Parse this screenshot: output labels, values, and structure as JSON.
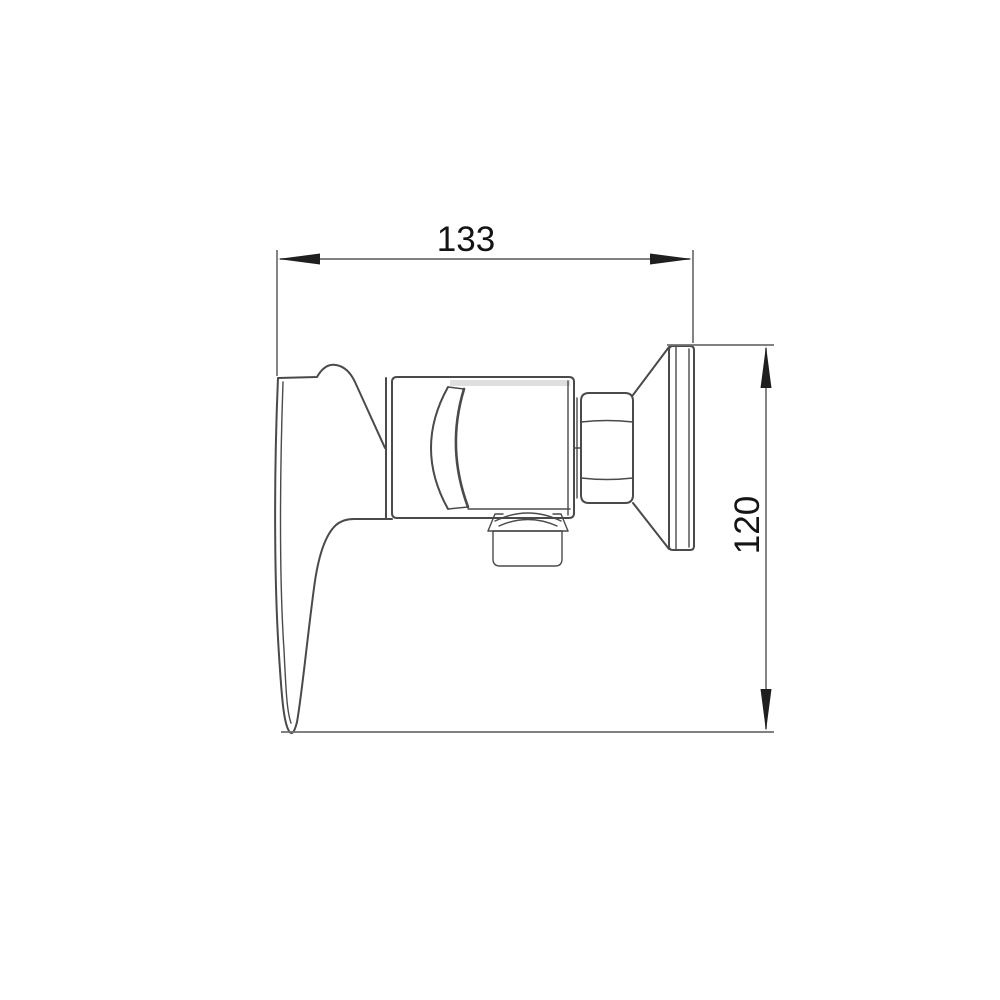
{
  "dimensions": {
    "width": "133",
    "height": "120"
  },
  "colors": {
    "background": "#ffffff",
    "outline": "#4a4a4a",
    "shading": "#c4c4c4",
    "dimension_line": "#6f6f6f",
    "arrow": "#1f1f1f",
    "label_text": "#141414",
    "thread_dark": "#4a4a4a",
    "thread_light": "#9b9b9b"
  }
}
